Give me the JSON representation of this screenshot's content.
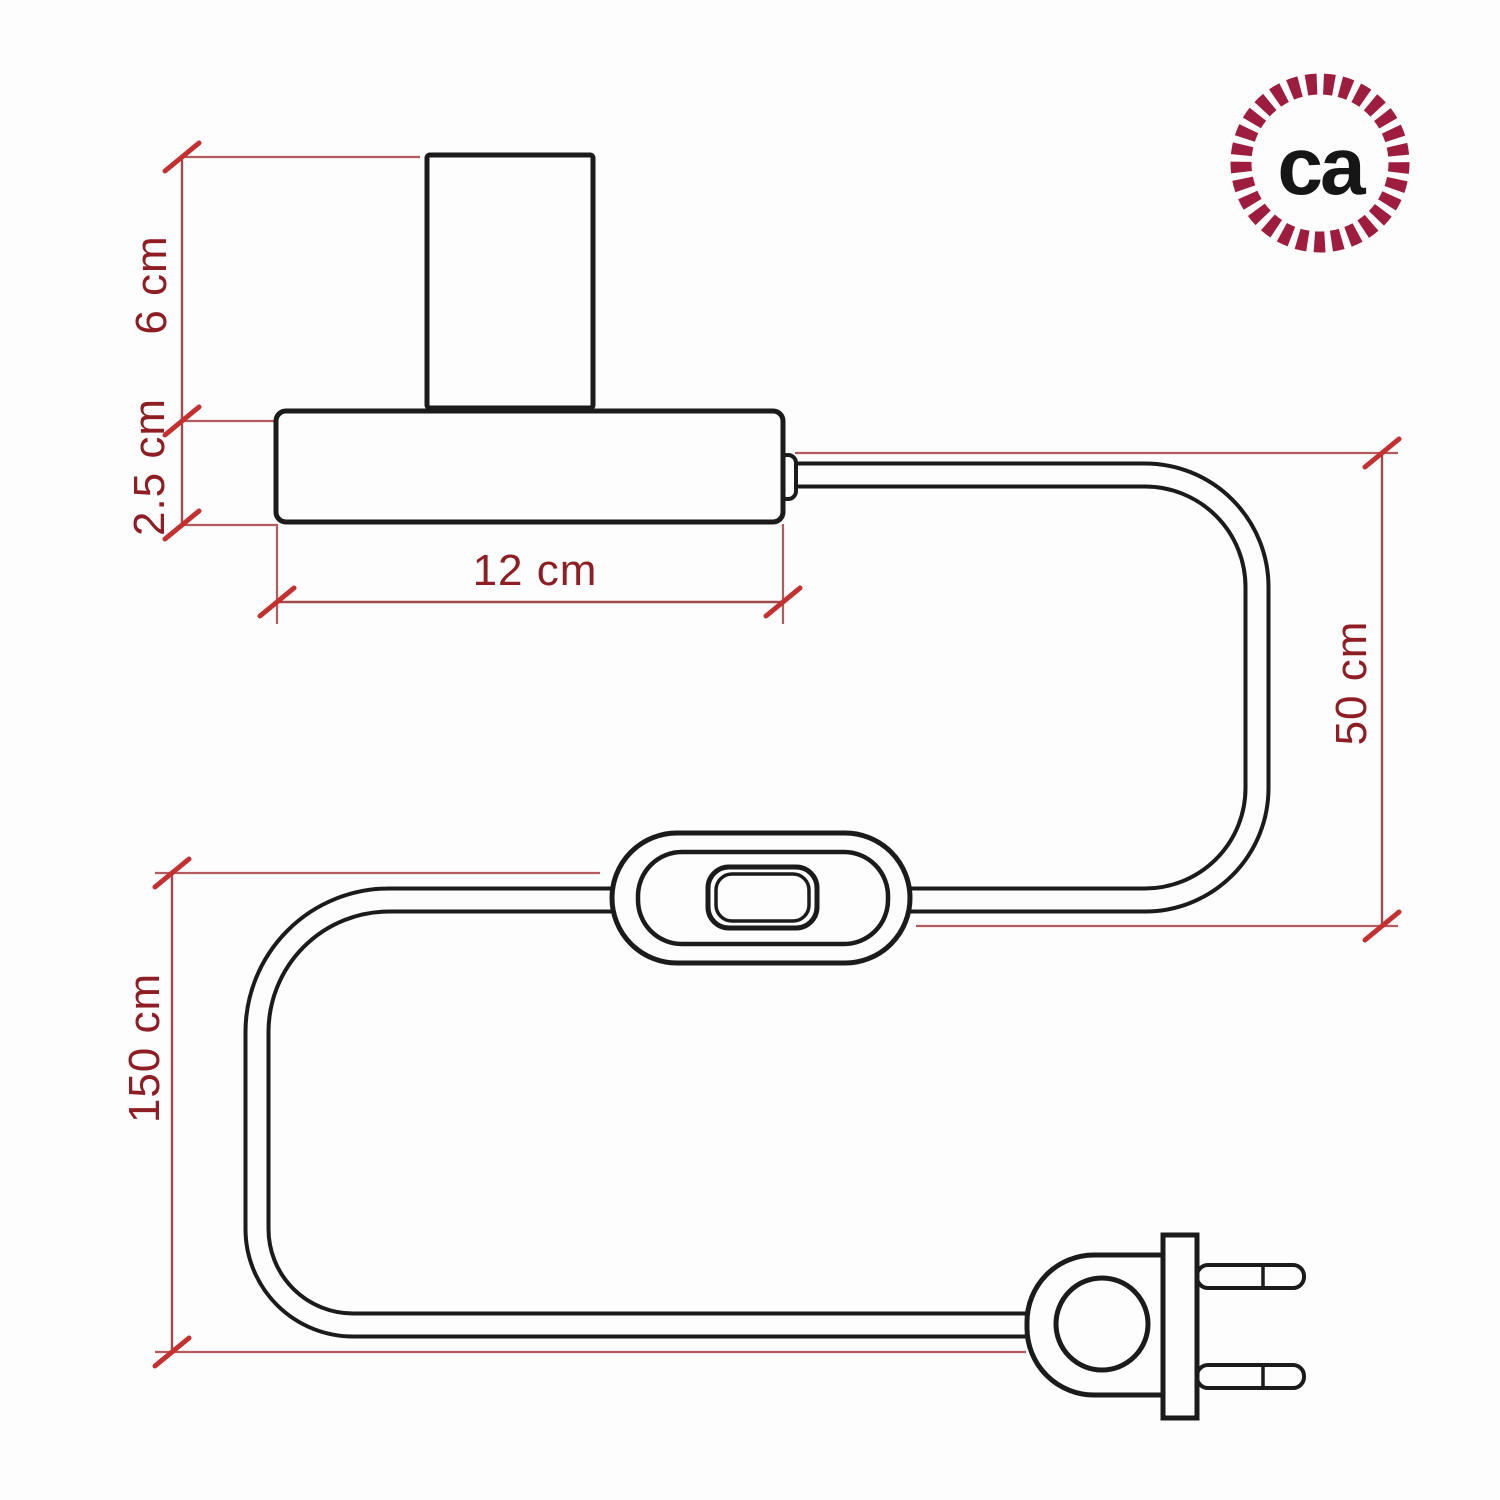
{
  "title": "Table lamp with inline switch and two-pin plug - dimension diagram",
  "dimensions": {
    "socket_height": "6 cm",
    "base_height": "2.5 cm",
    "base_width": "12 cm",
    "cable_lamp_to_switch": "50 cm",
    "cable_switch_to_plug": "150 cm"
  },
  "logo": {
    "text": "ca"
  },
  "colors": {
    "outline": "#1b1b1b",
    "dimension_text": "#8e1d24",
    "dimension_line": "#aa5254",
    "tick_mark": "#c4302f",
    "logo_ring": "#9e1d3e"
  }
}
